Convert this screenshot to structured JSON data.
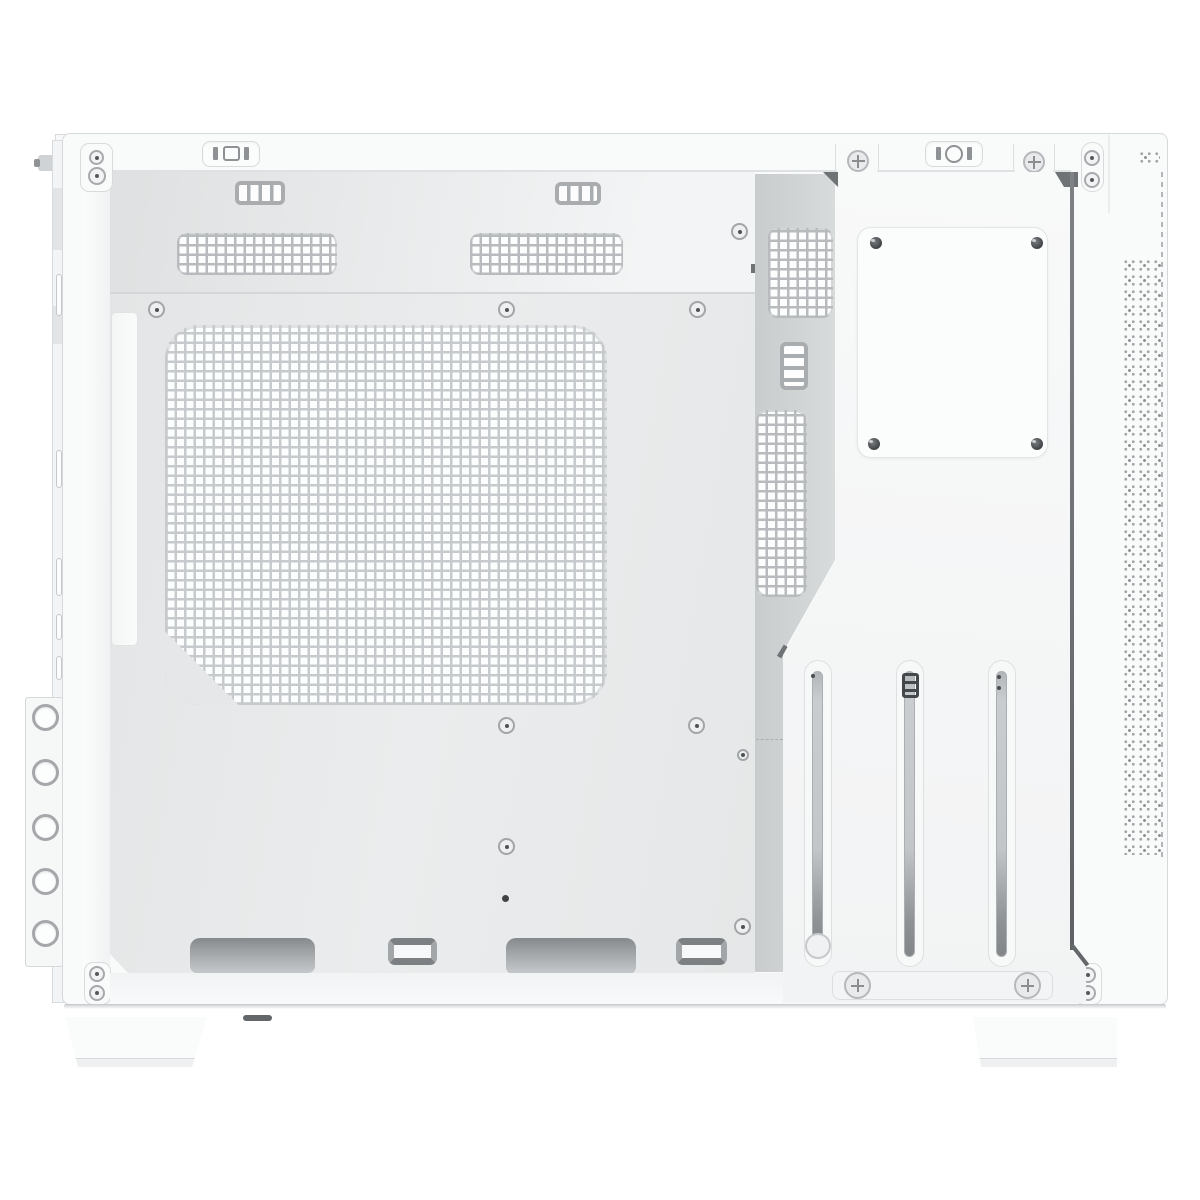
{
  "scene": {
    "type": "product-photo",
    "subject": "White micro-ATX PC case shown from the open side with the side panel removed, empty interior",
    "background_color": "#ffffff",
    "visible_text": ""
  },
  "palette": {
    "case_white": "#f9fafa",
    "panel_white": "#fbfcfc",
    "tray_gray": "#e8eaec",
    "recess_gray": "#d2d5d6",
    "mesh_line_gray": "#c6cacc",
    "vent_dark_gray": "#7c8083",
    "slot_fill_gray": "#b0b4b6",
    "divider_dark": "#63676a",
    "edge_light": "#dcdfe1"
  },
  "parts": {
    "case": "white PC case body",
    "top_rail": "top frame rail with stamped cutouts",
    "io_cutout_left": "top rail cutout with I-O-I stamping (left)",
    "io_cutout_right": "top rail cutout with I-O-I stamping (right)",
    "left_bracket": "external bracket rail with five thumbscrew holes",
    "pillar": "front interior pillar",
    "top_wall": "angled top radiator wall with vents",
    "tray": "motherboard tray",
    "big_mesh": "large square ventilation mesh / fan mount area",
    "mesh_strip": "top ventilation mesh strip",
    "mesh_block": "rear ventilation mesh block",
    "plate": "removable tray plate with four screws",
    "slots": "three vertical expansion slot cutouts",
    "bracket_bar": "expansion slot retention bar with two screws",
    "floor_cutout": "bottom cable routing cutout",
    "cable_tie": "cable tie stamping",
    "front_mesh": "front panel fine perforation strip",
    "foot": "case foot",
    "standoff": "motherboard standoff screw"
  },
  "counts": {
    "expansion_slots": 3,
    "thumbscrew_holes": 5,
    "plate_screws": 4,
    "floor_cutouts": 2,
    "cable_tie_points": 2,
    "top_mesh_strips": 2,
    "rear_mesh_blocks": 2,
    "standoff_screws": 10,
    "feet": 2
  }
}
